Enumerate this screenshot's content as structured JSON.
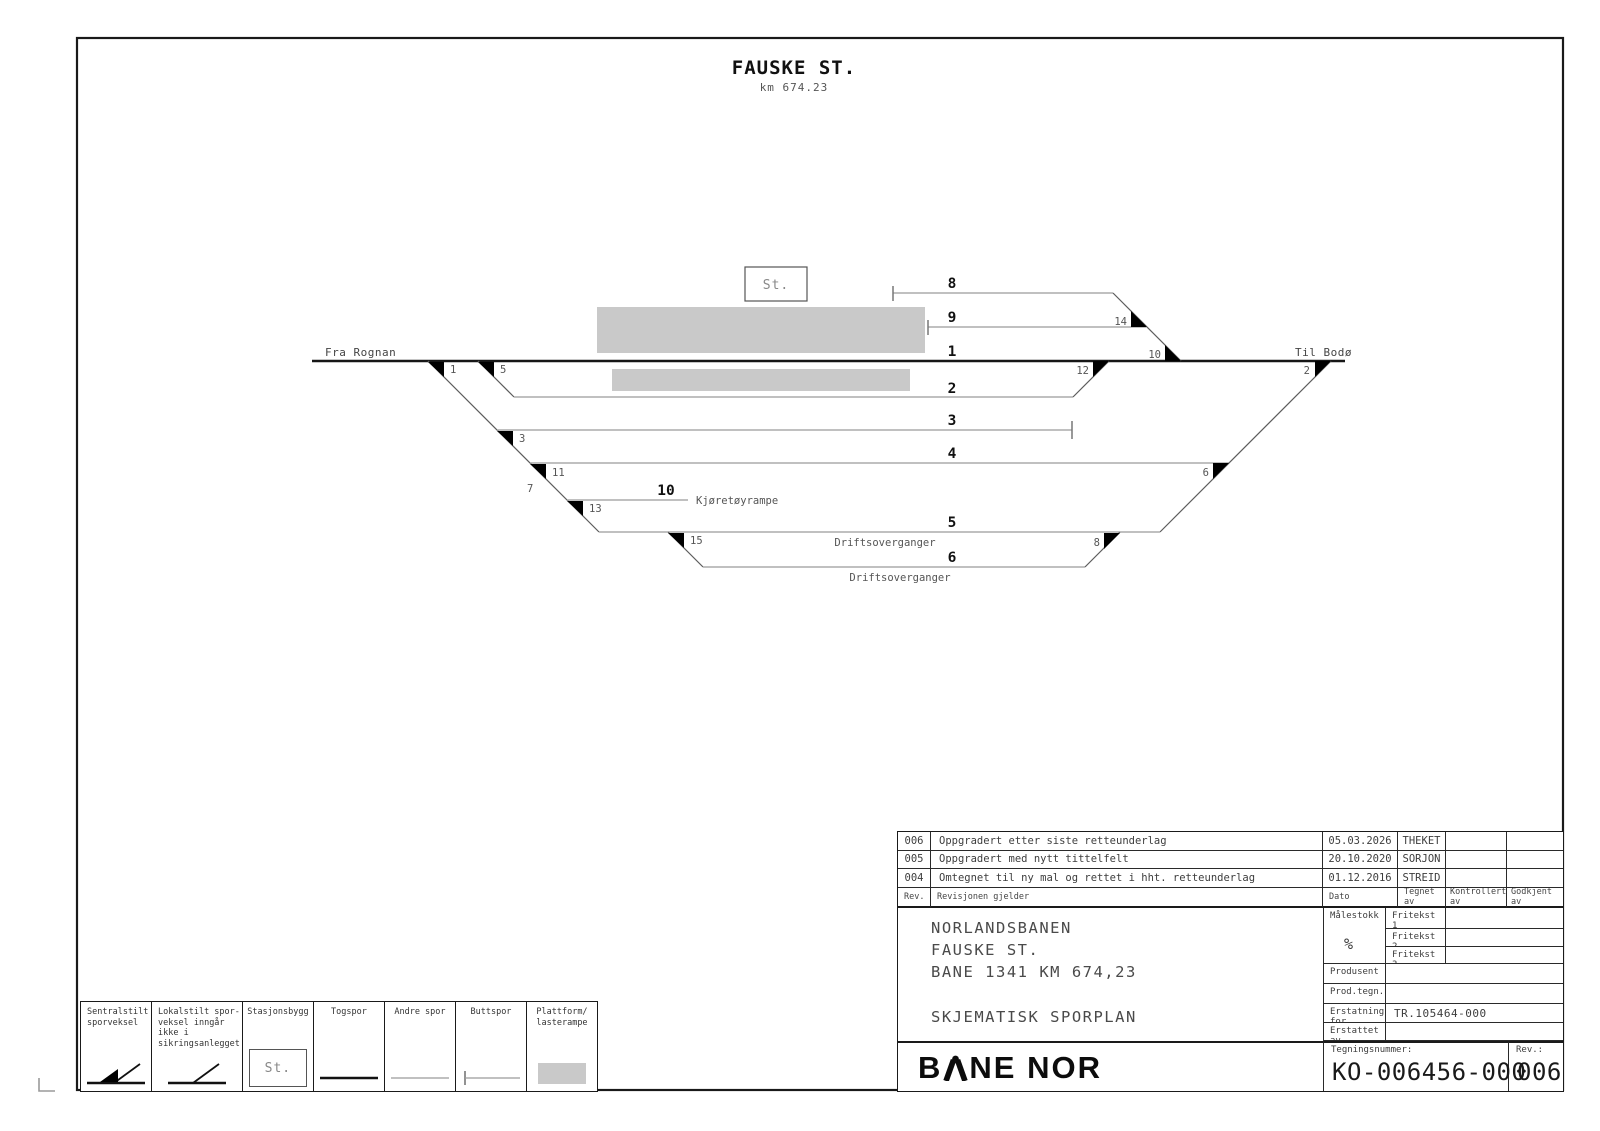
{
  "page_title": {
    "station": "FAUSKE ST.",
    "km": "km 674.23"
  },
  "diagram": {
    "from_label": "Fra Rognan",
    "to_label": "Til Bodø",
    "station_box_label": "St.",
    "ramp_label": "Kjøretøyrampe",
    "crossing_label_track5": "Driftsoverganger",
    "crossing_label_track6": "Driftsoverganger",
    "track_numbers": {
      "t1": "1",
      "t2": "2",
      "t3": "3",
      "t4": "4",
      "t5": "5",
      "t6": "6",
      "t8": "8",
      "t9": "9",
      "t10": "10"
    },
    "switch_numbers": {
      "s1": "1",
      "s2": "2",
      "s3": "3",
      "s5": "5",
      "s6": "6",
      "s7": "7",
      "s8": "8",
      "s10": "10",
      "s11": "11",
      "s12": "12",
      "s13": "13",
      "s14": "14",
      "s15": "15"
    }
  },
  "legend": {
    "items": [
      {
        "label": "Sentralstilt\nsporveksel"
      },
      {
        "label": "Lokalstilt spor-\nveksel inngår ikke i\nsikringsanlegget"
      },
      {
        "label": "Stasjonsbygg",
        "symbol_text": "St."
      },
      {
        "label": "Togspor"
      },
      {
        "label": "Andre spor"
      },
      {
        "label": "Buttspor"
      },
      {
        "label": "Plattform/\nlasterampe"
      }
    ]
  },
  "revision_table": {
    "headers": {
      "rev": "Rev.",
      "description": "Revisjonen gjelder",
      "date": "Dato",
      "drawn": "Tegnet av",
      "checked": "Kontrollert av",
      "approved": "Godkjent av"
    },
    "rows": [
      {
        "rev": "006",
        "description": "Oppgradert etter siste retteunderlag",
        "date": "05.03.2026",
        "drawn": "THEKET"
      },
      {
        "rev": "005",
        "description": "Oppgradert med nytt tittelfelt",
        "date": "20.10.2020",
        "drawn": "SORJON"
      },
      {
        "rev": "004",
        "description": "Omtegnet til ny mal og rettet i hht. retteunderlag",
        "date": "01.12.2016",
        "drawn": "STREID"
      }
    ]
  },
  "title_block": {
    "line1": "NORLANDSBANEN",
    "line2": "FAUSKE ST.",
    "line3": "BANE 1341 KM 674,23",
    "drawing_type": "SKJEMATISK SPORPLAN",
    "malestokk_label": "Målestokk",
    "malestokk_value": "%",
    "fritekst1": "Fritekst 1",
    "fritekst2": "Fritekst 2",
    "fritekst3": "Fritekst 3",
    "produsent_label": "Produsent",
    "prodtegnnr_label": "Prod.tegn.nr.",
    "erstatning_label": "Erstatning for",
    "erstatning_value": "TR.105464-000",
    "erstattet_label": "Erstattet av"
  },
  "footer": {
    "logo_part1": "B",
    "logo_part2": "NE NOR",
    "tegningsnummer_label": "Tegningsnummer:",
    "drawing_number": "KO-006456-000",
    "rev_label": "Rev.:",
    "rev_value": "006"
  },
  "colors": {
    "platform_gray": "#c9c9c9",
    "line_black": "#1a1a1a",
    "track_gray": "#9b9b9b"
  }
}
